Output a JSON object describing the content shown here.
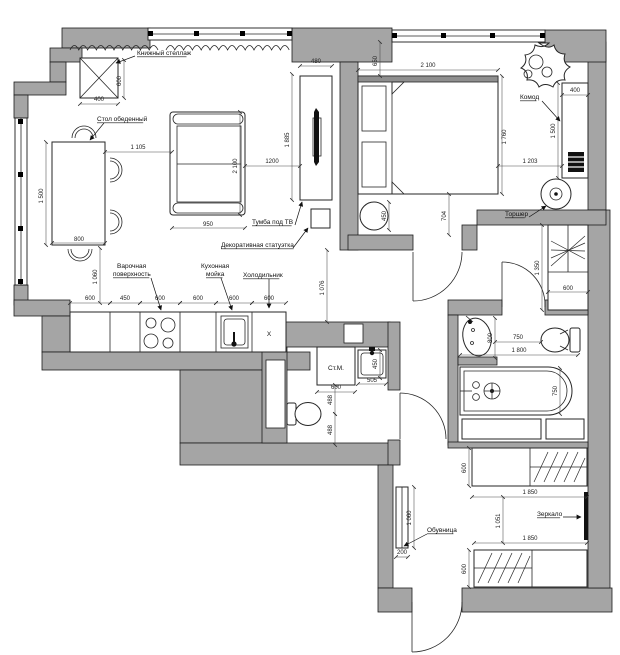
{
  "title": "apartment-floor-plan",
  "colors": {
    "wall": "#a5a5a5",
    "line": "#1c1c1c",
    "background": "#ffffff"
  },
  "labels": [
    {
      "t": "Книжный стеллаж",
      "x": 137,
      "y": 55,
      "ul": 1,
      "leader": [
        135,
        56,
        116,
        63
      ]
    },
    {
      "t": "Стол обеденный",
      "x": 97,
      "y": 121,
      "ul": 1,
      "leader": [
        104,
        123,
        90,
        140
      ]
    },
    {
      "t": "Тумба под ТВ",
      "x": 252,
      "y": 224,
      "ul": 1,
      "leader": [
        295,
        225,
        302,
        202
      ]
    },
    {
      "t": "Декоративная статуэтка",
      "x": 221,
      "y": 247,
      "ul": 1,
      "leader": [
        293,
        248,
        308,
        228
      ]
    },
    {
      "t": "Варочная",
      "x": 117,
      "y": 268
    },
    {
      "t": "поверхность",
      "x": 113,
      "y": 276,
      "ul": 1,
      "leader": [
        151,
        278,
        161,
        310
      ]
    },
    {
      "t": "Кухонная",
      "x": 201,
      "y": 268
    },
    {
      "t": "мойка",
      "x": 206,
      "y": 276,
      "ul": 1,
      "leader": [
        221,
        278,
        232,
        310
      ]
    },
    {
      "t": "Холодильник",
      "x": 243,
      "y": 277,
      "ul": 1,
      "leader": [
        269,
        279,
        269,
        308
      ]
    },
    {
      "t": "Комод",
      "x": 520,
      "y": 99,
      "ul": 1,
      "leader": [
        542,
        101,
        560,
        121
      ]
    },
    {
      "t": "Торшер",
      "x": 505,
      "y": 216,
      "ul": 1,
      "leader": [
        529,
        217,
        546,
        206
      ]
    },
    {
      "t": "Обувница",
      "x": 427,
      "y": 532,
      "ul": 1,
      "leader": [
        427,
        534,
        404,
        546
      ]
    },
    {
      "t": "Зеркало",
      "x": 537,
      "y": 516,
      "ul": 1,
      "leader": [
        563,
        517,
        581,
        517
      ]
    },
    {
      "t": "Ст.М.",
      "x": 336,
      "y": 370,
      "size": 9.5,
      "anchor": "middle"
    },
    {
      "t": "X",
      "x": 269,
      "y": 336,
      "size": 10,
      "anchor": "middle"
    }
  ],
  "dimensions": [
    {
      "t": "400",
      "x": 99,
      "y": 101
    },
    {
      "t": "600",
      "x": 121,
      "y": 81,
      "v": 1
    },
    {
      "t": "1 500",
      "x": 43,
      "y": 196,
      "v": 1
    },
    {
      "t": "800",
      "x": 79,
      "y": 241
    },
    {
      "t": "1 105",
      "x": 138,
      "y": 149
    },
    {
      "t": "2 100",
      "x": 237,
      "y": 166,
      "v": 1
    },
    {
      "t": "950",
      "x": 208,
      "y": 226
    },
    {
      "t": "1200",
      "x": 272,
      "y": 163
    },
    {
      "t": "1 885",
      "x": 289,
      "y": 140,
      "v": 1
    },
    {
      "t": "480",
      "x": 316,
      "y": 63
    },
    {
      "t": "1 060",
      "x": 97,
      "y": 277,
      "v": 1
    },
    {
      "t": "1 076",
      "x": 324,
      "y": 288,
      "v": 1
    },
    {
      "t": "600",
      "x": 90,
      "y": 300
    },
    {
      "t": "450",
      "x": 125,
      "y": 300
    },
    {
      "t": "600",
      "x": 160,
      "y": 300
    },
    {
      "t": "600",
      "x": 198,
      "y": 300
    },
    {
      "t": "600",
      "x": 234,
      "y": 300
    },
    {
      "t": "600",
      "x": 269,
      "y": 300
    },
    {
      "t": "650",
      "x": 377,
      "y": 61,
      "v": 1
    },
    {
      "t": "2 100",
      "x": 428,
      "y": 67
    },
    {
      "t": "1 760",
      "x": 506,
      "y": 137,
      "v": 1
    },
    {
      "t": "1 203",
      "x": 530,
      "y": 163
    },
    {
      "t": "450",
      "x": 386,
      "y": 216,
      "v": 1
    },
    {
      "t": "704",
      "x": 446,
      "y": 216,
      "v": 1
    },
    {
      "t": "400",
      "x": 575,
      "y": 92
    },
    {
      "t": "1 500",
      "x": 555,
      "y": 131,
      "v": 1
    },
    {
      "t": "1 350",
      "x": 539,
      "y": 268,
      "v": 1
    },
    {
      "t": "600",
      "x": 568,
      "y": 290
    },
    {
      "t": "600",
      "x": 336,
      "y": 389
    },
    {
      "t": "505",
      "x": 372,
      "y": 382
    },
    {
      "t": "450",
      "x": 377,
      "y": 364,
      "v": 1
    },
    {
      "t": "488",
      "x": 332,
      "y": 400,
      "v": 1
    },
    {
      "t": "488",
      "x": 332,
      "y": 430,
      "v": 1
    },
    {
      "t": "800",
      "x": 492,
      "y": 338,
      "v": 1
    },
    {
      "t": "750",
      "x": 518,
      "y": 339
    },
    {
      "t": "1 800",
      "x": 519,
      "y": 352
    },
    {
      "t": "750",
      "x": 557,
      "y": 391,
      "v": 1
    },
    {
      "t": "600",
      "x": 466,
      "y": 468,
      "v": 1
    },
    {
      "t": "1 850",
      "x": 530,
      "y": 494
    },
    {
      "t": "1 051",
      "x": 500,
      "y": 521,
      "v": 1
    },
    {
      "t": "1 850",
      "x": 530,
      "y": 540
    },
    {
      "t": "600",
      "x": 466,
      "y": 569,
      "v": 1
    },
    {
      "t": "1 060",
      "x": 411,
      "y": 518,
      "v": 1
    },
    {
      "t": "200",
      "x": 402,
      "y": 554
    }
  ],
  "dim_lines": [
    [
      80,
      104,
      118,
      104
    ],
    [
      124,
      60,
      124,
      98
    ],
    [
      46,
      142,
      46,
      245
    ],
    [
      52,
      243,
      105,
      243
    ],
    [
      105,
      152,
      172,
      152
    ],
    [
      240,
      112,
      240,
      215
    ],
    [
      172,
      228,
      245,
      228
    ],
    [
      245,
      166,
      300,
      166
    ],
    [
      292,
      74,
      292,
      200
    ],
    [
      300,
      66,
      332,
      66
    ],
    [
      100,
      248,
      100,
      303
    ],
    [
      327,
      250,
      327,
      322
    ],
    [
      70,
      303,
      110,
      303
    ],
    [
      110,
      303,
      140,
      303
    ],
    [
      140,
      303,
      180,
      303
    ],
    [
      180,
      303,
      216,
      303
    ],
    [
      216,
      303,
      252,
      303
    ],
    [
      252,
      303,
      286,
      303
    ],
    [
      380,
      42,
      380,
      76
    ],
    [
      358,
      70,
      498,
      70
    ],
    [
      502,
      76,
      502,
      194
    ],
    [
      498,
      166,
      562,
      166
    ],
    [
      389,
      202,
      389,
      230
    ],
    [
      449,
      194,
      449,
      235
    ],
    [
      562,
      95,
      588,
      95
    ],
    [
      558,
      83,
      558,
      178
    ],
    [
      542,
      225,
      542,
      310
    ],
    [
      548,
      292,
      588,
      292
    ],
    [
      317,
      392,
      355,
      392
    ],
    [
      358,
      384,
      386,
      384
    ],
    [
      380,
      350,
      380,
      378
    ],
    [
      335,
      385,
      335,
      414
    ],
    [
      335,
      414,
      335,
      445
    ],
    [
      495,
      318,
      495,
      358
    ],
    [
      495,
      342,
      541,
      342
    ],
    [
      460,
      355,
      578,
      355
    ],
    [
      560,
      368,
      560,
      414
    ],
    [
      469,
      448,
      469,
      486
    ],
    [
      472,
      497,
      587,
      497
    ],
    [
      503,
      497,
      503,
      543
    ],
    [
      474,
      543,
      587,
      543
    ],
    [
      469,
      550,
      469,
      587
    ],
    [
      414,
      487,
      414,
      548
    ],
    [
      396,
      557,
      408,
      557
    ]
  ]
}
